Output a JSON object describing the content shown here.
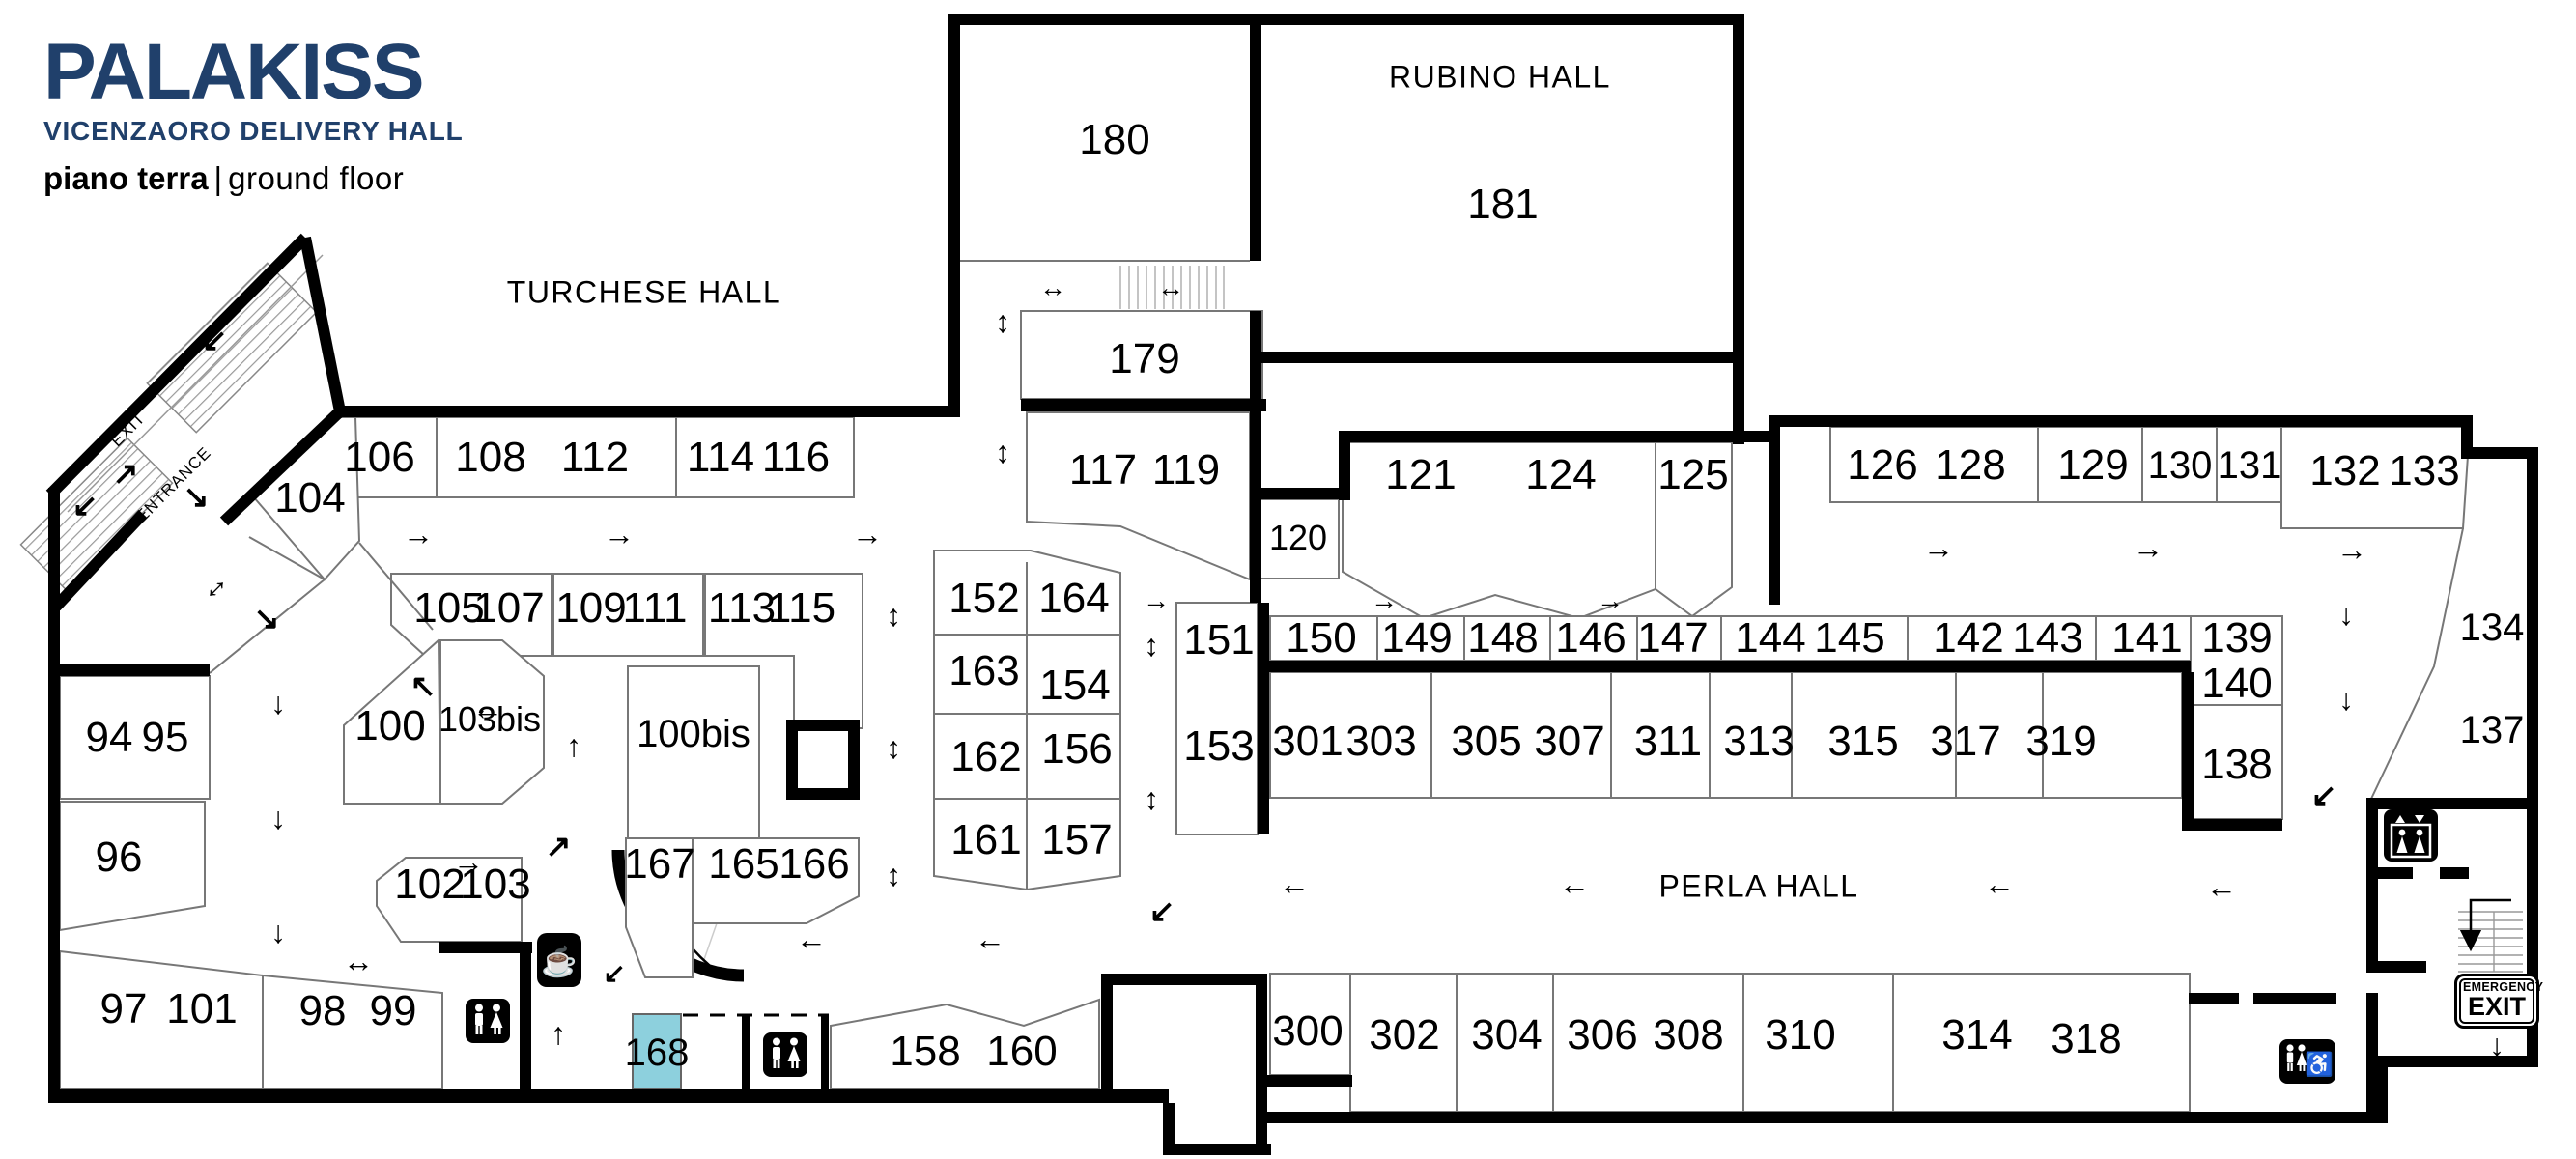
{
  "logo": {
    "title": "PALAKISS",
    "subtitle": "VICENZAORO DELIVERY HALL",
    "floor_primary": "piano terra",
    "floor_divider": "|",
    "floor_secondary": "ground floor"
  },
  "halls": {
    "turchese": "TURCHESE HALL",
    "rubino": "RUBINO HALL",
    "perla": "PERLA HALL"
  },
  "signs": {
    "exit": "EXIT",
    "entrance": "ENTRANCE",
    "emergency_top": "EMERGENCY",
    "emergency_bottom": "EXIT"
  },
  "glyphs": {
    "right": "→",
    "left": "←",
    "up": "↑",
    "down": "↓",
    "up_down": "↕",
    "left_right": "↔",
    "down_left": "↙",
    "up_right": "↗",
    "down_right": "↘",
    "up_left": "↖",
    "coffee": "☕",
    "wheelchair": "♿"
  },
  "colors": {
    "brand_navy": "#20406b",
    "highlight_teal": "#8dd0dd",
    "wall": "#000000"
  },
  "highlighted_booth": "168",
  "booths": {
    "b94": "94",
    "b95": "95",
    "b96": "96",
    "b97": "97",
    "b98": "98",
    "b99": "99",
    "b100": "100",
    "b100bis": "100bis",
    "b101": "101",
    "b102": "102",
    "b103": "103",
    "b103bis": "103bis",
    "b104": "104",
    "b105": "105",
    "b106": "106",
    "b107": "107",
    "b108": "108",
    "b109": "109",
    "b111": "111",
    "b112": "112",
    "b113": "113",
    "b114": "114",
    "b115": "115",
    "b116": "116",
    "b117": "117",
    "b119": "119",
    "b120": "120",
    "b121": "121",
    "b124": "124",
    "b125": "125",
    "b126": "126",
    "b128": "128",
    "b129": "129",
    "b130": "130",
    "b131": "131",
    "b132": "132",
    "b133": "133",
    "b134": "134",
    "b137": "137",
    "b138": "138",
    "b139": "139",
    "b140": "140",
    "b141": "141",
    "b142": "142",
    "b143": "143",
    "b144": "144",
    "b145": "145",
    "b146": "146",
    "b147": "147",
    "b148": "148",
    "b149": "149",
    "b150": "150",
    "b151": "151",
    "b152": "152",
    "b153": "153",
    "b154": "154",
    "b156": "156",
    "b157": "157",
    "b158": "158",
    "b160": "160",
    "b161": "161",
    "b162": "162",
    "b163": "163",
    "b164": "164",
    "b165": "165",
    "b166": "166",
    "b167": "167",
    "b168": "168",
    "b179": "179",
    "b180": "180",
    "b181": "181",
    "b300": "300",
    "b301": "301",
    "b302": "302",
    "b303": "303",
    "b304": "304",
    "b305": "305",
    "b306": "306",
    "b307": "307",
    "b308": "308",
    "b310": "310",
    "b311": "311",
    "b313": "313",
    "b314": "314",
    "b315": "315",
    "b317": "317",
    "b318": "318",
    "b319": "319"
  }
}
